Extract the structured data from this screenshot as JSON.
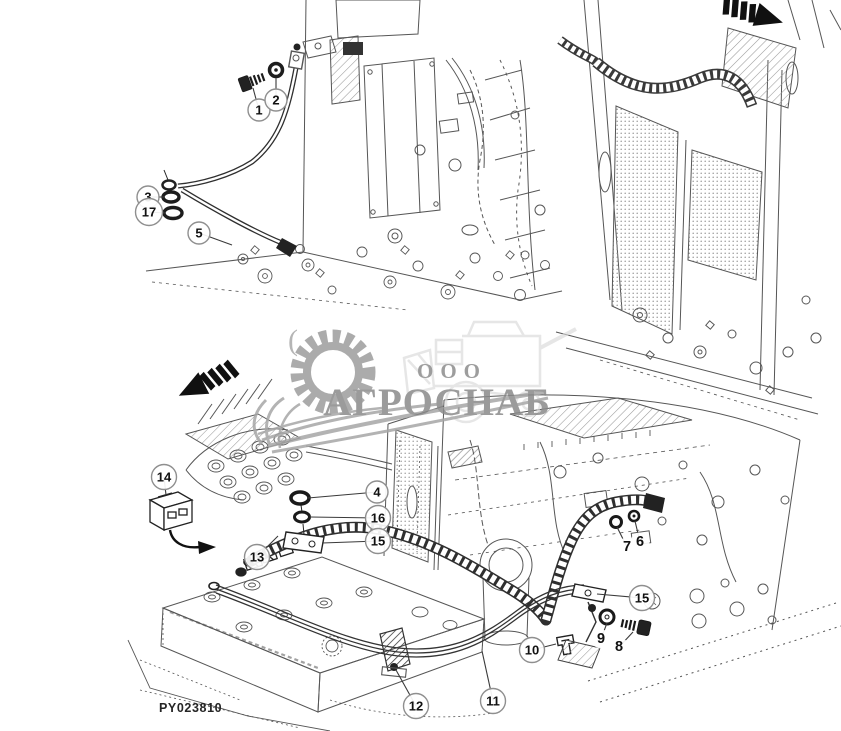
{
  "diagram": {
    "part_code": "PY023810",
    "watermark": {
      "prefix": "ООО",
      "name": "АГРОСНАБ",
      "artifact": "("
    },
    "icons": [
      {
        "name": "direction-arrow-top-right"
      },
      {
        "name": "direction-arrow-mid-left"
      }
    ],
    "callouts": [
      {
        "label": "1",
        "x": 259,
        "y": 110,
        "circled": true,
        "lx": 253,
        "ly": 88
      },
      {
        "label": "2",
        "x": 276,
        "y": 100,
        "circled": true,
        "lx": 276,
        "ly": 78
      },
      {
        "label": "3",
        "x": 148,
        "y": 197,
        "circled": true,
        "lx": 164,
        "ly": 197
      },
      {
        "label": "17",
        "x": 149,
        "y": 212,
        "circled": true,
        "lx": 165,
        "ly": 213
      },
      {
        "label": "5",
        "x": 199,
        "y": 233,
        "circled": true,
        "lx": 232,
        "ly": 245
      },
      {
        "label": "14",
        "x": 164,
        "y": 477,
        "circled": true,
        "lx": 166,
        "ly": 495
      },
      {
        "label": "4",
        "x": 377,
        "y": 492,
        "circled": true,
        "lx": 308,
        "ly": 498
      },
      {
        "label": "16",
        "x": 378,
        "y": 518,
        "circled": true,
        "lx": 310,
        "ly": 517
      },
      {
        "label": "15",
        "x": 378,
        "y": 541,
        "circled": true,
        "lx": 322,
        "ly": 543
      },
      {
        "label": "13",
        "x": 257,
        "y": 557,
        "circled": true,
        "lx": 278,
        "ly": 536
      },
      {
        "label": "7",
        "x": 627,
        "y": 547,
        "circled": false,
        "lx": 617,
        "ly": 527
      },
      {
        "label": "6",
        "x": 640,
        "y": 542,
        "circled": false,
        "lx": 635,
        "ly": 521
      },
      {
        "label": "15",
        "x": 642,
        "y": 598,
        "circled": true,
        "lx": 597,
        "ly": 594
      },
      {
        "label": "9",
        "x": 601,
        "y": 639,
        "circled": false,
        "lx": 607,
        "ly": 623
      },
      {
        "label": "8",
        "x": 619,
        "y": 647,
        "circled": false,
        "lx": 633,
        "ly": 632
      },
      {
        "label": "10",
        "x": 532,
        "y": 650,
        "circled": true,
        "lx": 556,
        "ly": 644
      },
      {
        "label": "12",
        "x": 416,
        "y": 706,
        "circled": true,
        "lx": 396,
        "ly": 670
      },
      {
        "label": "11",
        "x": 493,
        "y": 701,
        "circled": true,
        "lx": 482,
        "ly": 651
      }
    ]
  }
}
